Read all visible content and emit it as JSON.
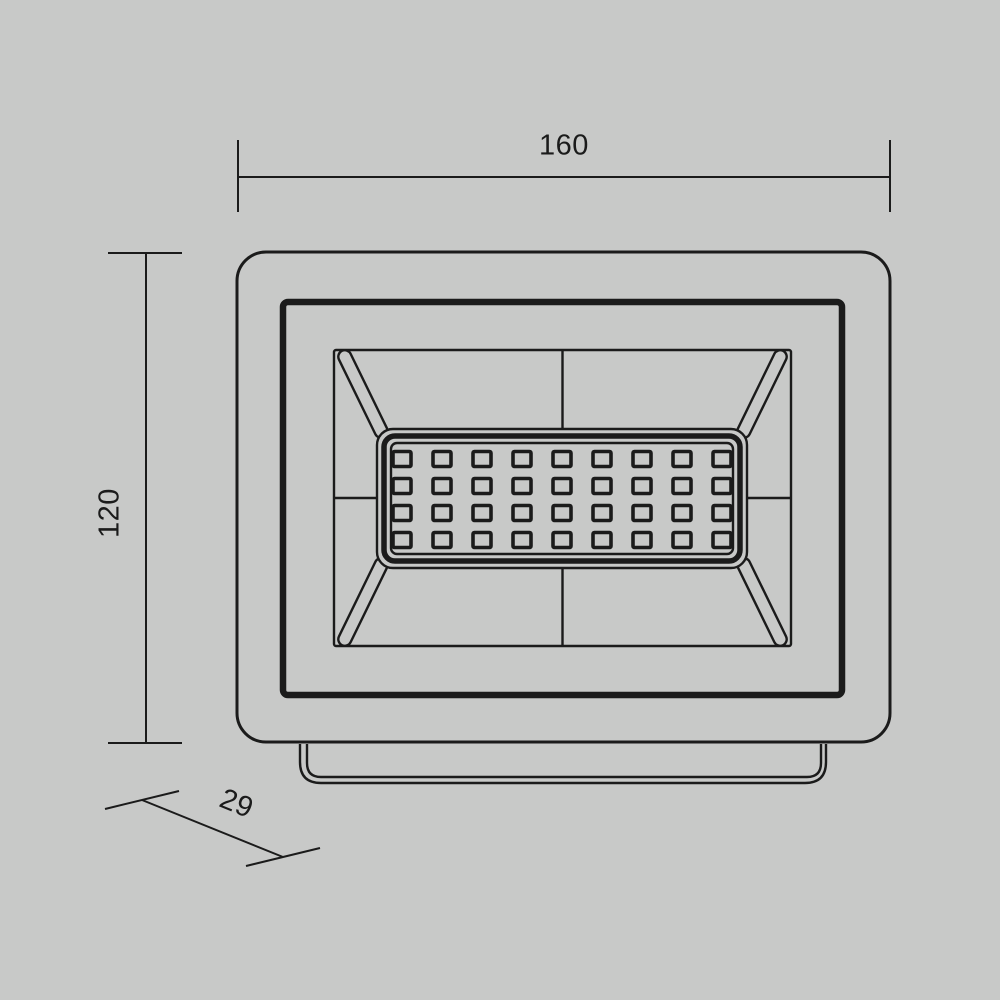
{
  "canvas": {
    "background": "#c8c9c8",
    "line_color": "#1b1b1b"
  },
  "drawing": {
    "type": "technical-dimension-drawing",
    "subject": "LED floodlight front view with mounting bracket",
    "dimensions": {
      "width_label": "160",
      "height_label": "120",
      "depth_label": "29"
    },
    "led_panel": {
      "rows": 4,
      "columns": 9
    }
  }
}
